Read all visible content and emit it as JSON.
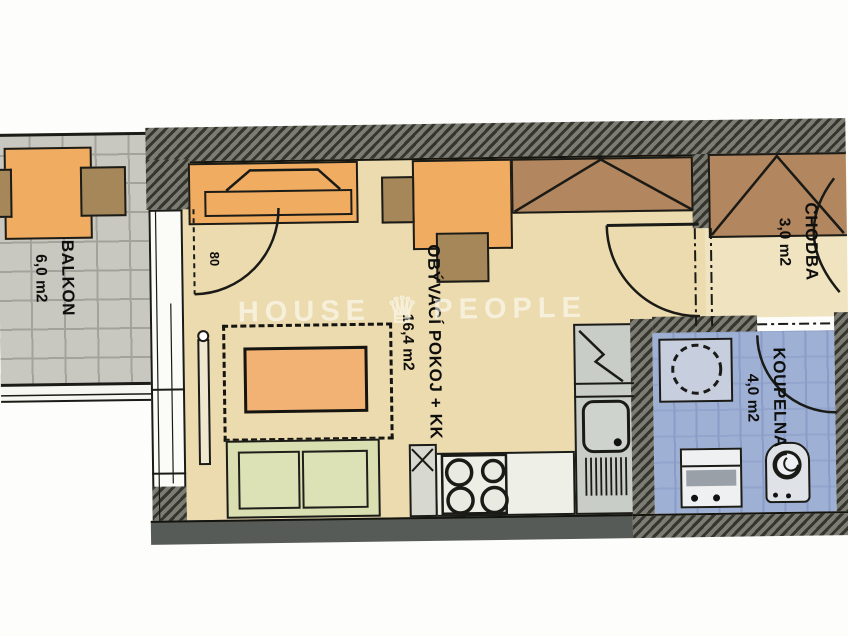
{
  "watermark": {
    "word_left": "HOUSE",
    "word_right": "PEOPLE",
    "icon": "crown"
  },
  "rooms": {
    "balkon": {
      "name": "BALKON",
      "area": "6,0 m2"
    },
    "obyvaci_pokoj": {
      "name": "OBÝVACÍ POKOJ + KK",
      "area": "16,4 m2"
    },
    "chodba": {
      "name": "CHODBA",
      "area": "3,0 m2"
    },
    "koupelna": {
      "name": "KOUPELNA",
      "area": "4,0 m2"
    }
  },
  "annotations": {
    "balcony_door_width": "80"
  },
  "colors": {
    "floor_living": "#ecdbae",
    "floor_hall": "#f0e3c0",
    "floor_bath": "#9fb0d5",
    "floor_balcony": "#c9c8c0",
    "furniture_orange": "#f0ad62",
    "furniture_wood": "#a5875a",
    "wardrobe": "#b2865e",
    "sofa": "#dadfb2",
    "wall": "#3c3c38"
  }
}
